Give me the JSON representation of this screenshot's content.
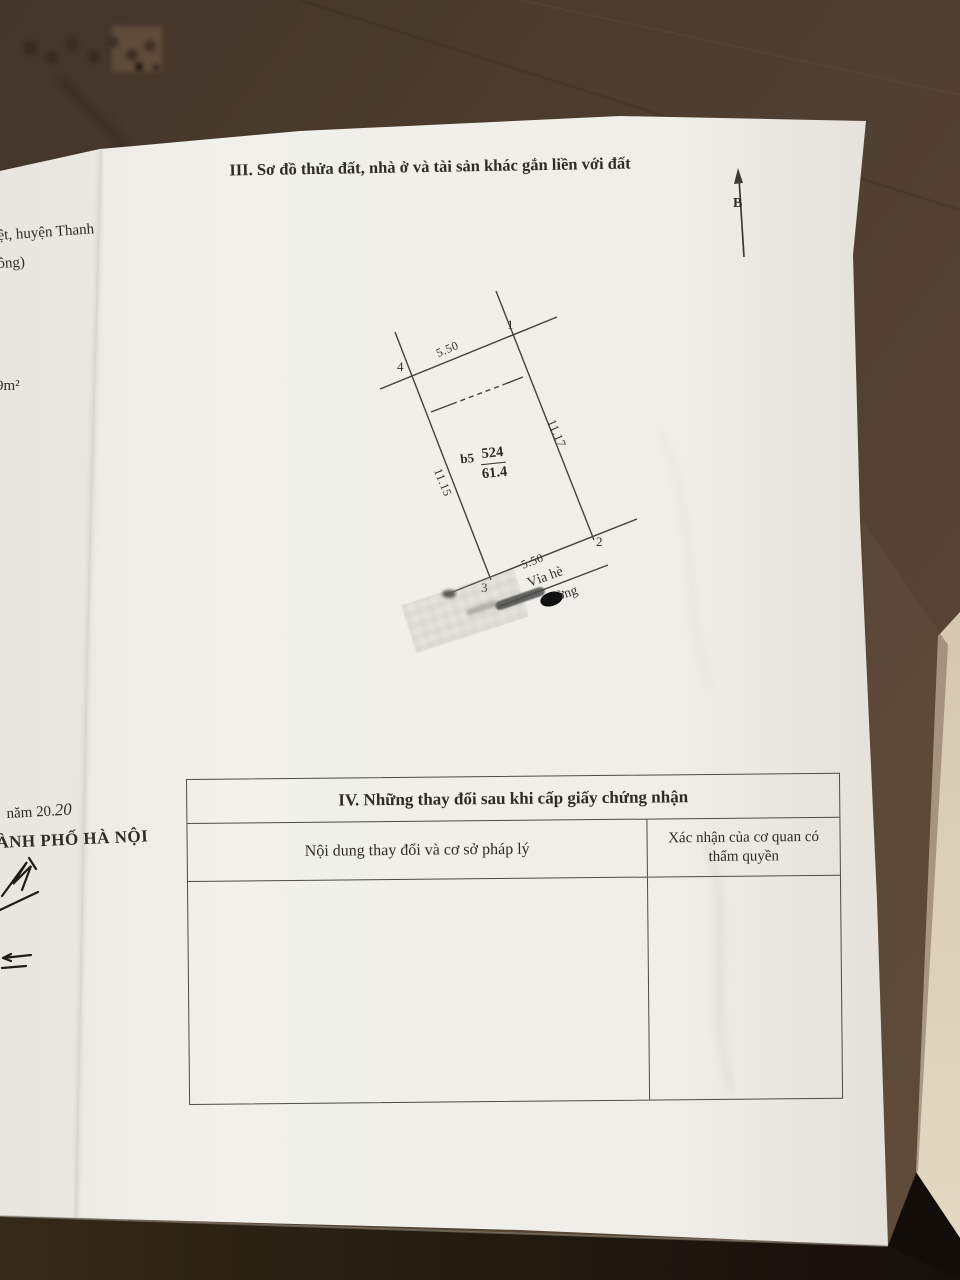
{
  "colors": {
    "paper": "#f0efe9",
    "ink": "#2e2b28",
    "wood_top": "#4c3c2f",
    "wood_bottom": "#241b12",
    "floor": "#dccfb8",
    "redaction": "#111111"
  },
  "section3": {
    "title": "III. Sơ đồ thửa đất, nhà ở và tài sản khác gắn liền với đất",
    "north_label": "B"
  },
  "plot": {
    "corner_1": "1",
    "corner_2": "2",
    "corner_3": "3",
    "corner_4": "4",
    "dim_top": "5.50",
    "dim_right": "11.17",
    "dim_left": "11.15",
    "dim_bottom": "5.50",
    "parcel_prefix": "b5",
    "parcel_number": "524",
    "parcel_area": "61.4",
    "sidewalk_label": "Vỉa hè",
    "street_label_partial": "ờng"
  },
  "left_page": {
    "fragment_district": "ệt, huyện Thanh",
    "fragment_paren": "ông)",
    "fragment_area": "9m²",
    "fragment_year_printed": "năm 20.",
    "fragment_year_hand": "20",
    "fragment_city": "ÀNH PHỐ HÀ NỘI"
  },
  "section4": {
    "title": "IV. Những thay đổi sau khi cấp giấy chứng nhận",
    "col1_header": "Nội dung thay đổi và cơ sở pháp lý",
    "col2_header": "Xác nhận của cơ quan có thẩm quyền"
  }
}
